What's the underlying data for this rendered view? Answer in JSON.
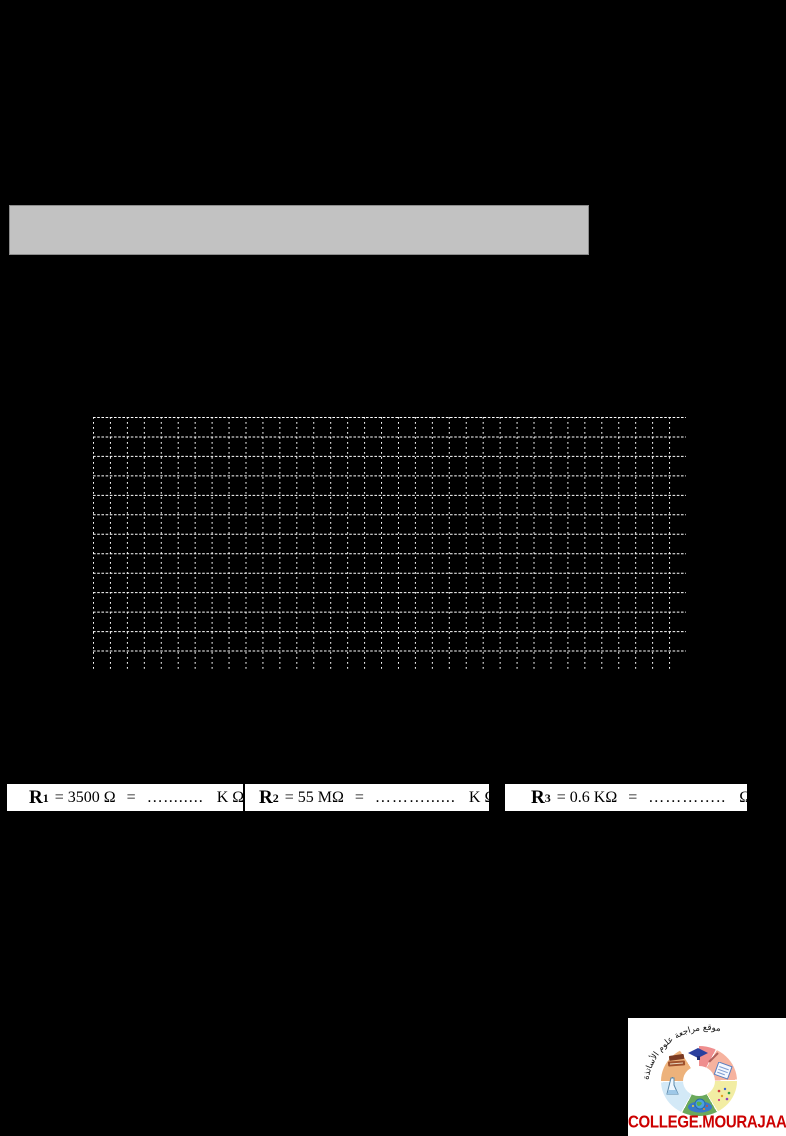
{
  "page": {
    "background": "#000000"
  },
  "header_bar": {
    "fill": "#c2c2c2",
    "border": "#8c8c8c"
  },
  "grid": {
    "columns": 35,
    "rows": 13,
    "line_color": "#ffffff"
  },
  "answer_boxes": [
    {
      "symbol": "R",
      "subscript": "1",
      "value": "= 3500 Ω",
      "equals": "=",
      "dots": "…........",
      "unit": "K Ω"
    },
    {
      "symbol": "R",
      "subscript": "2",
      "value": "= 55 MΩ",
      "equals": "=",
      "dots": "………......",
      "unit": "K Ω"
    },
    {
      "symbol": "R",
      "subscript": "3",
      "value": "= 0.6 KΩ",
      "equals": "=",
      "dots": "…………..",
      "unit": "Ω"
    }
  ],
  "logo": {
    "arabic_arc_text": "موقع مراجعة علوم الأساتذة",
    "website": "COLLEGE.MOURAJAA.COM",
    "website_color": "#cc0000",
    "ring_segments": [
      {
        "name": "graduation-cap-segment",
        "color": "#ef8e8e"
      },
      {
        "name": "notebook-segment",
        "color": "#f6b39f"
      },
      {
        "name": "confetti-segment",
        "color": "#f2eda3"
      },
      {
        "name": "globe-segment",
        "color": "#6aa95c"
      },
      {
        "name": "chemistry-flask-segment",
        "color": "#d3e9f7"
      },
      {
        "name": "books-segment",
        "color": "#edb27b"
      }
    ]
  }
}
